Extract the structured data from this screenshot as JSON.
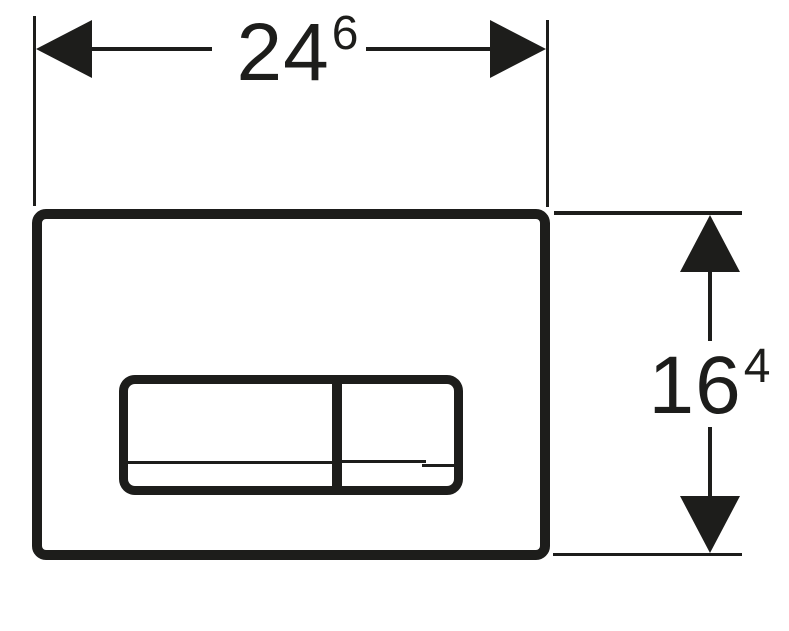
{
  "drawing": {
    "description": "Technical dimension drawing of a rectangular dual-button flush plate, front view",
    "width_dimension": {
      "value": "24",
      "superscript": "6"
    },
    "height_dimension": {
      "value": "16",
      "superscript": "4"
    }
  },
  "colors": {
    "ink": "#1d1d1b",
    "background": "#ffffff"
  }
}
